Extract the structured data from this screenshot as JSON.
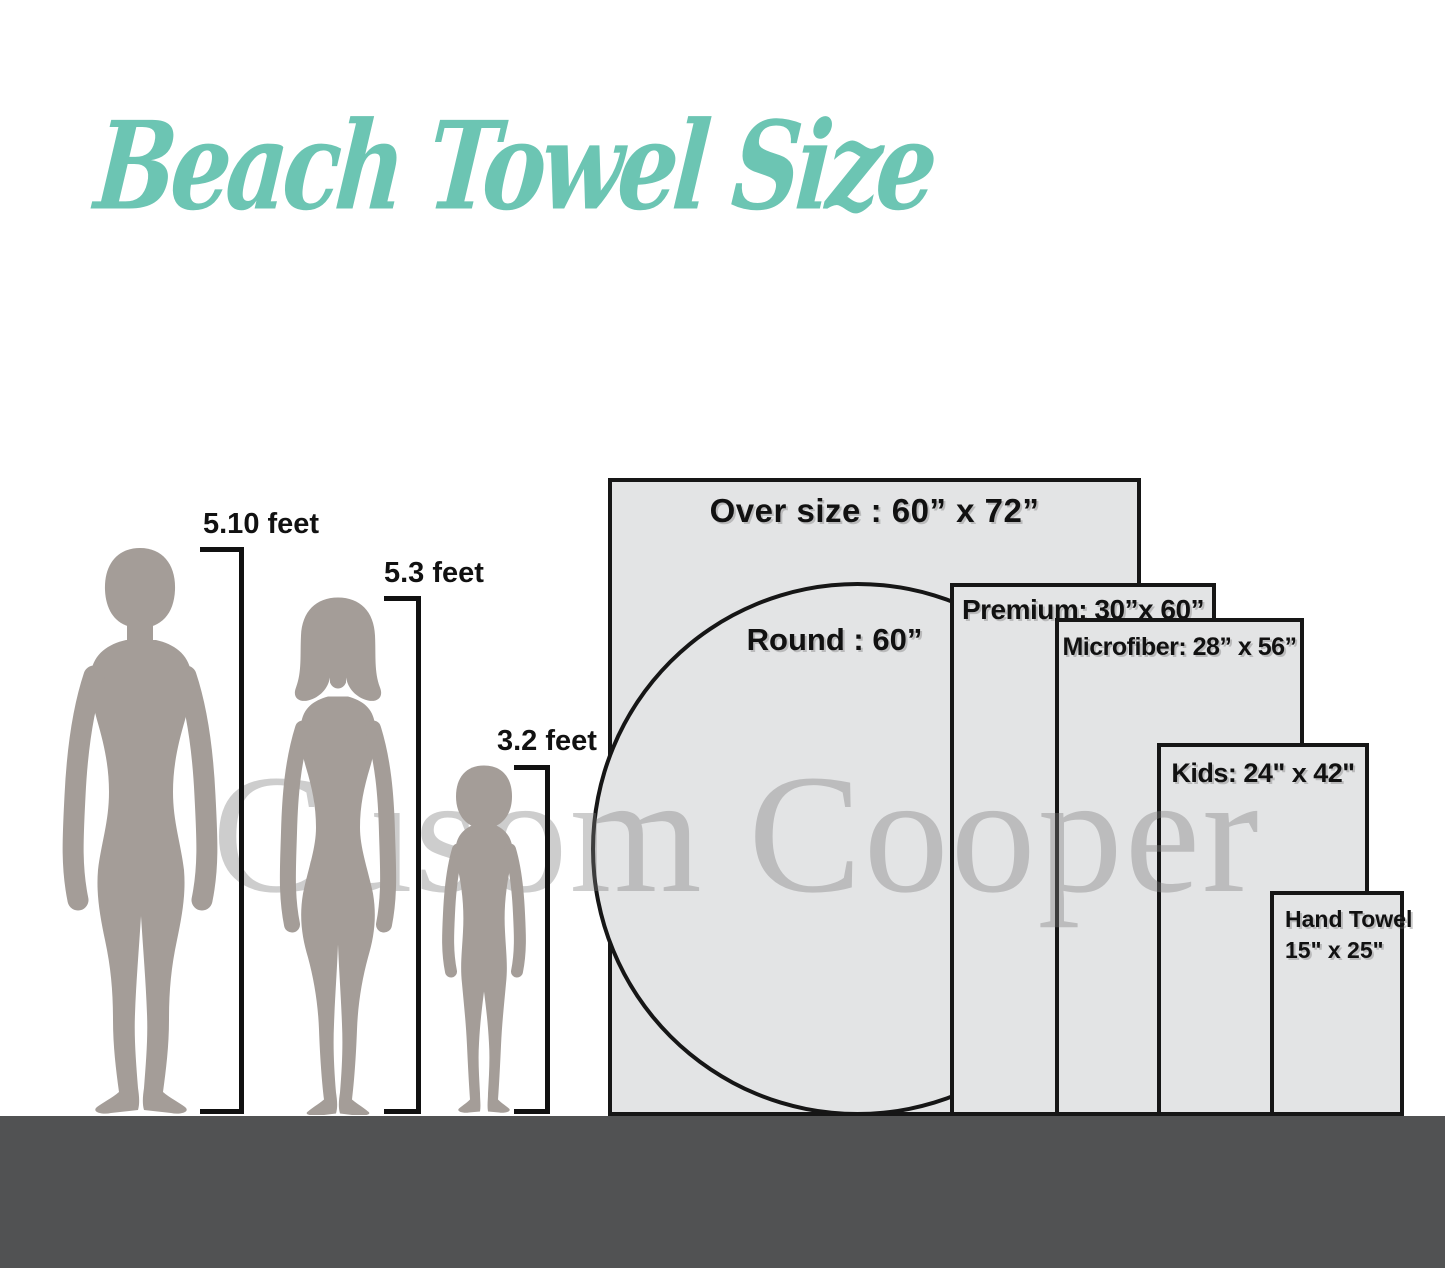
{
  "title": {
    "text": "Beach Towel Size"
  },
  "watermark": {
    "text": "Cusom Cooper"
  },
  "people": [
    {
      "name": "man",
      "height_label": "5.10 feet"
    },
    {
      "name": "woman",
      "height_label": "5.3 feet"
    },
    {
      "name": "child",
      "height_label": "3.2 feet"
    }
  ],
  "towels": [
    {
      "name": "Over size",
      "size": "60\" x 72\"",
      "label": "Over size : 60” x 72”"
    },
    {
      "name": "Round",
      "size": "60\"",
      "label": "Round : 60”"
    },
    {
      "name": "Premium",
      "size": "30\" x 60\"",
      "label": "Premium: 30”x 60”"
    },
    {
      "name": "Microfiber",
      "size": "28\" x 56\"",
      "label": "Microfiber: 28” x 56”"
    },
    {
      "name": "Kids",
      "size": "24\" x 42\"",
      "label": "Kids: 24\" x 42\""
    },
    {
      "name": "Hand Towel",
      "size": "15\" x 25\"",
      "label_line1": "Hand Towel",
      "label_line2": "15\" x 25\""
    }
  ],
  "colors": {
    "title_teal": "#6cc5b3",
    "towel_fill": "#e3e4e5",
    "towel_border": "#161616",
    "silhouette_gray": "#a49d98",
    "ground_gray": "#515253",
    "watermark_gray": "#d2d2d2"
  }
}
